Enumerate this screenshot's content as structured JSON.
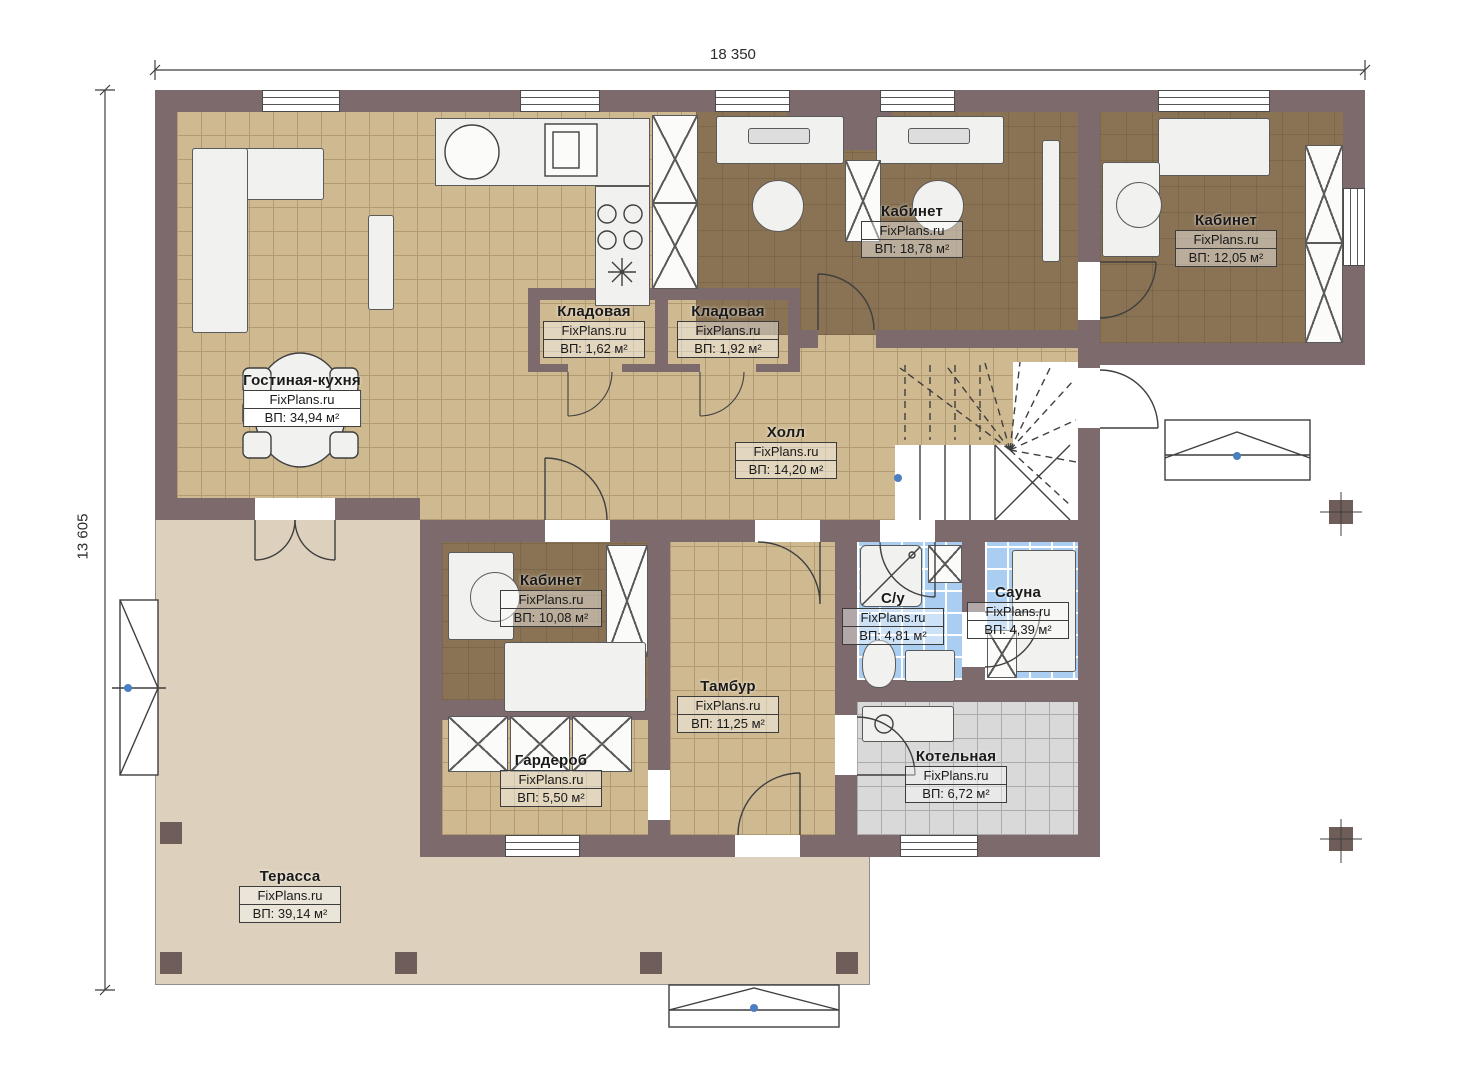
{
  "dimensions": {
    "top": "18 350",
    "left": "13 605"
  },
  "rooms": [
    {
      "name": "Гостиная-кухня",
      "brand": "FixPlans.ru",
      "area": "ВП: 34,94 м²"
    },
    {
      "name": "Кабинет",
      "brand": "FixPlans.ru",
      "area": "ВП: 18,78 м²"
    },
    {
      "name": "Кабинет",
      "brand": "FixPlans.ru",
      "area": "ВП: 12,05 м²"
    },
    {
      "name": "Кладовая",
      "brand": "FixPlans.ru",
      "area": "ВП: 1,62 м²"
    },
    {
      "name": "Кладовая",
      "brand": "FixPlans.ru",
      "area": "ВП: 1,92 м²"
    },
    {
      "name": "Холл",
      "brand": "FixPlans.ru",
      "area": "ВП: 14,20 м²"
    },
    {
      "name": "Кабинет",
      "brand": "FixPlans.ru",
      "area": "ВП: 10,08 м²"
    },
    {
      "name": "С/у",
      "brand": "FixPlans.ru",
      "area": "ВП: 4,81 м²"
    },
    {
      "name": "Сауна",
      "brand": "FixPlans.ru",
      "area": "ВП: 4,39 м²"
    },
    {
      "name": "Тамбур",
      "brand": "FixPlans.ru",
      "area": "ВП: 11,25 м²"
    },
    {
      "name": "Гардероб",
      "brand": "FixPlans.ru",
      "area": "ВП: 5,50 м²"
    },
    {
      "name": "Котельная",
      "brand": "FixPlans.ru",
      "area": "ВП: 6,72 м²"
    },
    {
      "name": "Терасса",
      "brand": "FixPlans.ru",
      "area": "ВП: 39,14 м²"
    }
  ],
  "colors": {
    "wall": "#7c6a6c",
    "floor_tan": "#cfb991",
    "floor_brown": "#8a7354",
    "tile_blue": "#a9cef1",
    "tile_gray": "#d9d9d9",
    "terrace": "#ddd1bd",
    "marker_blue": "#4a7fc1"
  }
}
